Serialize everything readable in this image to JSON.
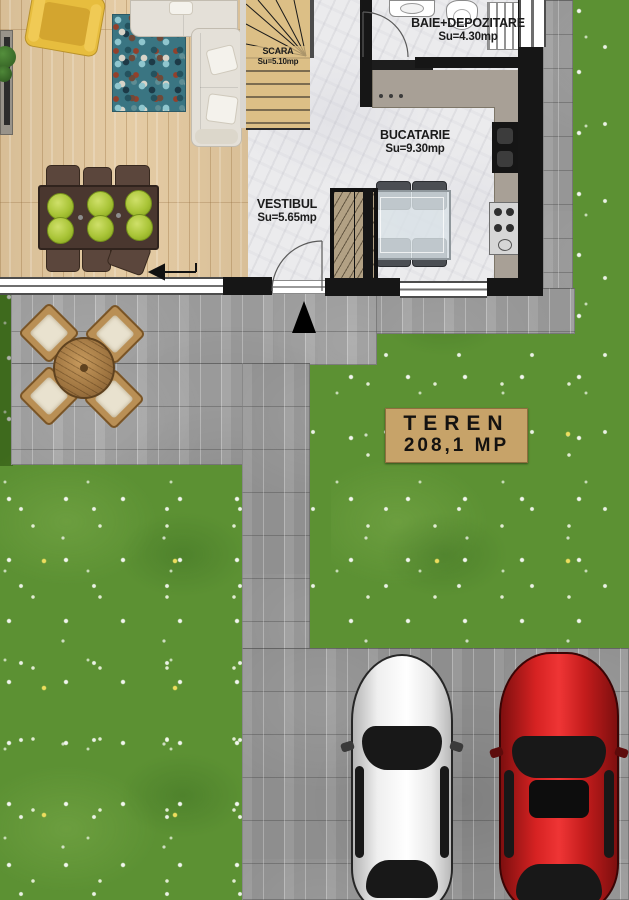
{
  "rooms": {
    "scara": {
      "name": "SCARA",
      "area": "Su=5.10mp"
    },
    "baie": {
      "name": "BAIE+DEPOZITARE",
      "area": "Su=4.30mp"
    },
    "bucatarie": {
      "name": "BUCATARIE",
      "area": "Su=9.30mp"
    },
    "vestibul": {
      "name": "VESTIBUL",
      "area": "Su=5.65mp"
    }
  },
  "land_sign": {
    "line1": "TEREN",
    "line2": "208,1 MP"
  },
  "colors": {
    "grass": "#5c9133",
    "paving": "#a1a1a1",
    "wood_floor": "#e3c89e",
    "marble_floor": "#ebebed",
    "stairs": "#dcbf86",
    "sign_board": "#c7a369",
    "white_car": "#f2f2f2",
    "red_car": "#d62222",
    "plate": "#a9c437",
    "sofa": "#e4e0d8",
    "armchair": "#e7bd3e"
  }
}
